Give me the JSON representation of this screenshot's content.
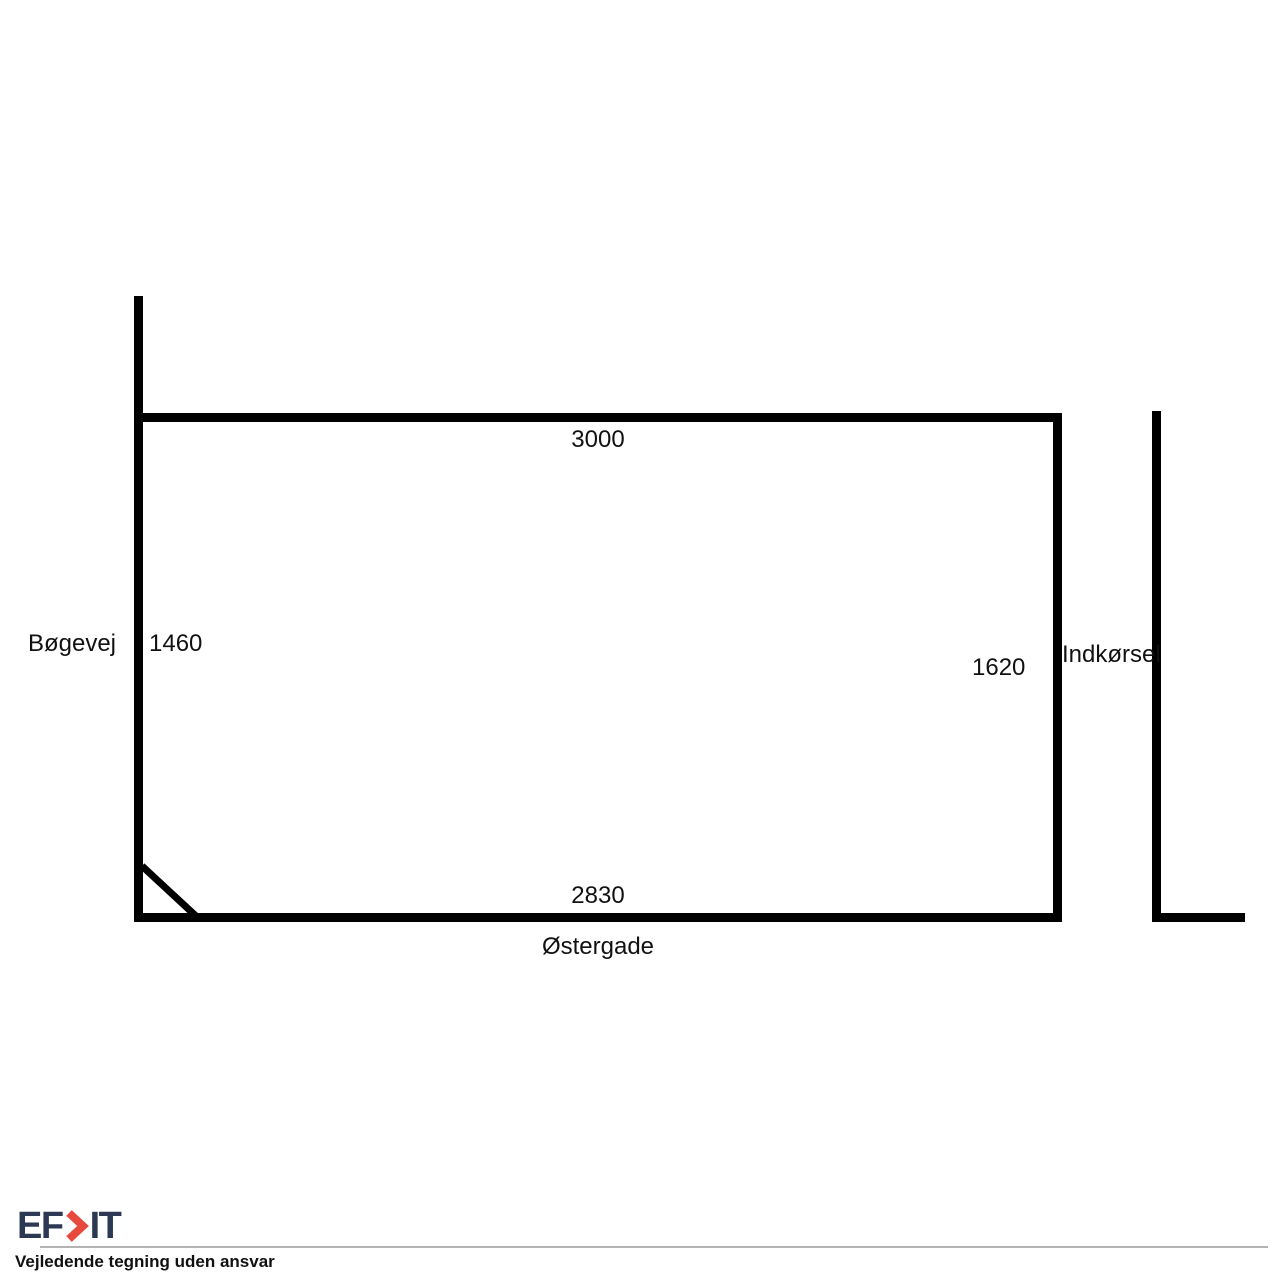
{
  "diagram": {
    "dims": {
      "top": "3000",
      "left": "1460",
      "right": "1620",
      "bottom": "2830"
    },
    "streets": {
      "left": "Bøgevej",
      "bottom": "Østergade",
      "right": "Indkørsel"
    },
    "line_color": "#000000"
  },
  "footer": {
    "logo_text_left": "EF",
    "logo_text_right": "IT",
    "logo_color": "#2d3954",
    "logo_chevron_color": "#e74a3c",
    "disclaimer": "Vejledende tegning uden ansvar"
  }
}
